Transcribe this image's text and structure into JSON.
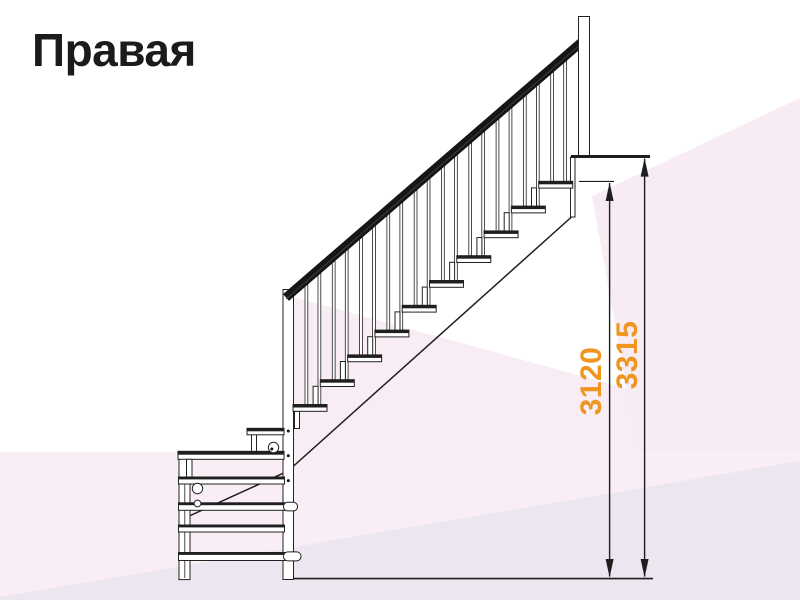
{
  "title": "Правая",
  "drawing": {
    "kind": "staircase-side-elevation",
    "dimensions": {
      "inner": {
        "value": "3120"
      },
      "outer": {
        "value": "3315"
      }
    },
    "dimension_color": "#F0951E",
    "line_color": "#1e1e1e",
    "handrail_color": "#161616",
    "background_tints": [
      "#f9eef6",
      "#f7ebf4",
      "#ece6f0"
    ]
  }
}
